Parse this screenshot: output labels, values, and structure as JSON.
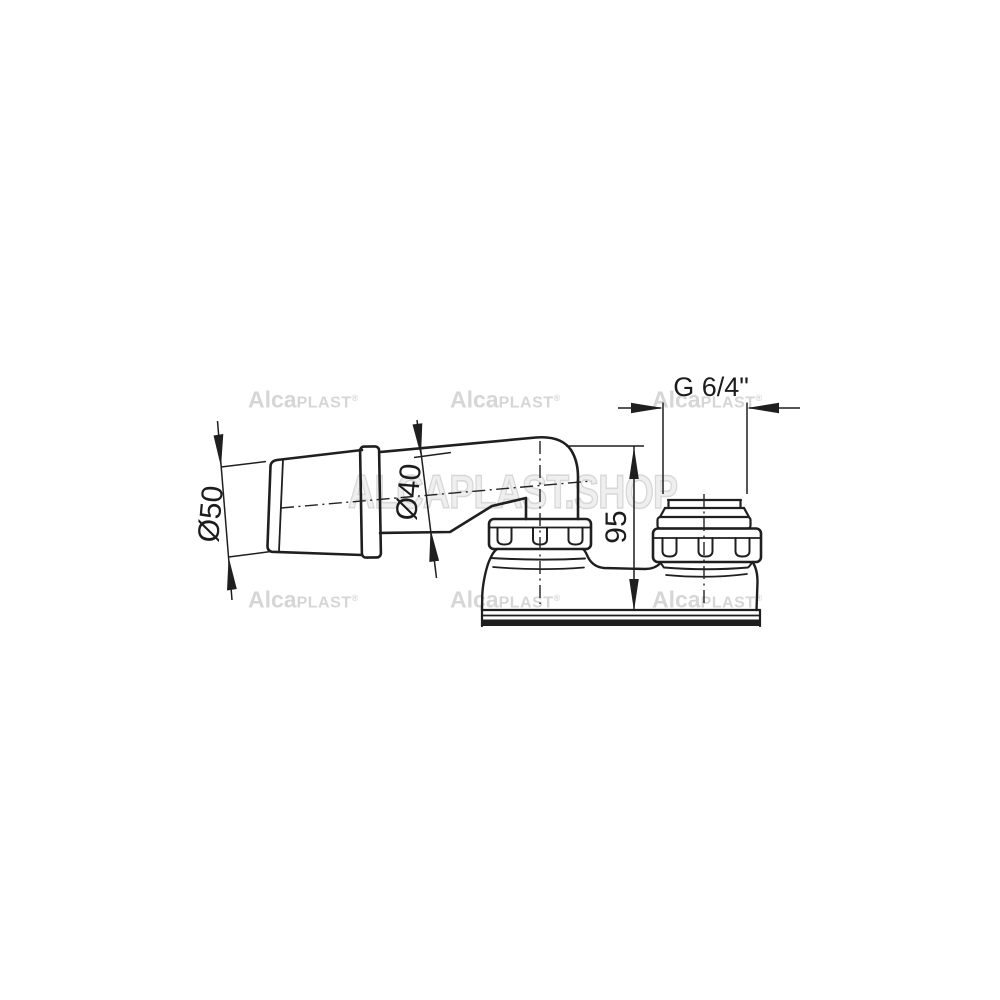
{
  "dimensions": {
    "inlet_diameter": "Ø50",
    "pipe_diameter": "Ø40",
    "height": "95",
    "thread": "G 6/4\""
  },
  "watermarks": {
    "small": {
      "bold": "Alca",
      "caps": "PLAST",
      "reg": "®"
    },
    "large": "ALCAPLAST.SHOP"
  },
  "colors": {
    "line": "#1f1f1f",
    "dimension_text": "#1c1c1c",
    "watermark_small": "#d6d6d6",
    "watermark_large_fill": "#efefef",
    "background": "#ffffff"
  }
}
